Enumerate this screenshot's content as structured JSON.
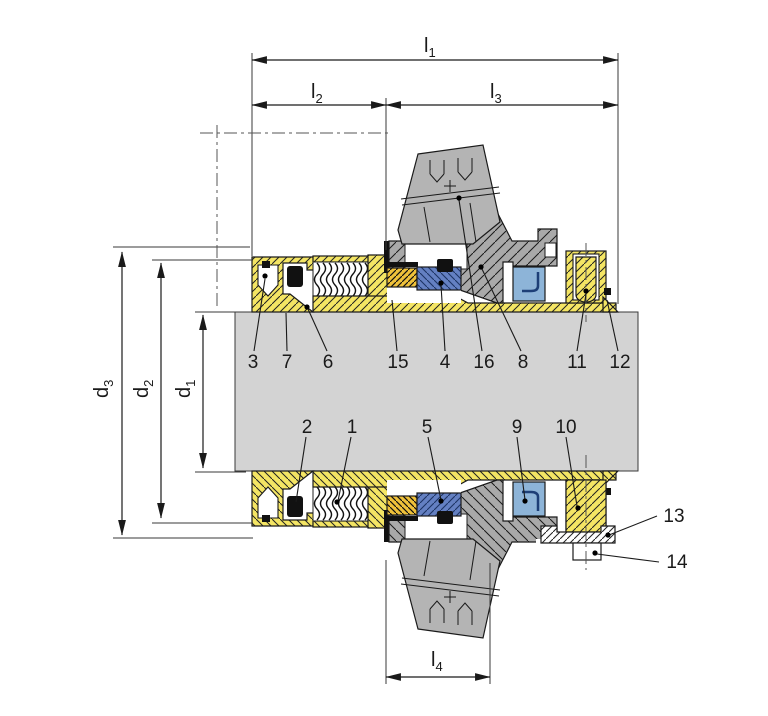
{
  "dims": {
    "l1": {
      "base": "l",
      "sub": "1"
    },
    "l2": {
      "base": "l",
      "sub": "2"
    },
    "l3": {
      "base": "l",
      "sub": "3"
    },
    "l4": {
      "base": "l",
      "sub": "4"
    },
    "d1": {
      "base": "d",
      "sub": "1"
    },
    "d2": {
      "base": "d",
      "sub": "2"
    },
    "d3": {
      "base": "d",
      "sub": "3"
    }
  },
  "part_numbers": {
    "p1": "1",
    "p2": "2",
    "p3": "3",
    "p4": "4",
    "p5": "5",
    "p6": "6",
    "p7": "7",
    "p8": "8",
    "p9": "9",
    "p10": "10",
    "p11": "11",
    "p12": "12",
    "p13": "13",
    "p14": "14",
    "p15": "15",
    "p16": "16"
  },
  "colors": {
    "component_yellow": "#f4e564",
    "carbon_gold": "#efc13a",
    "seal_face_blue": "#6480c2",
    "seat_blue": "#8db4d8",
    "gland_gray": "#a9a9a9",
    "port_gray": "#b4b4b4",
    "shaft_gray": "#d3d3d3",
    "outline": "#1a1a1a"
  }
}
